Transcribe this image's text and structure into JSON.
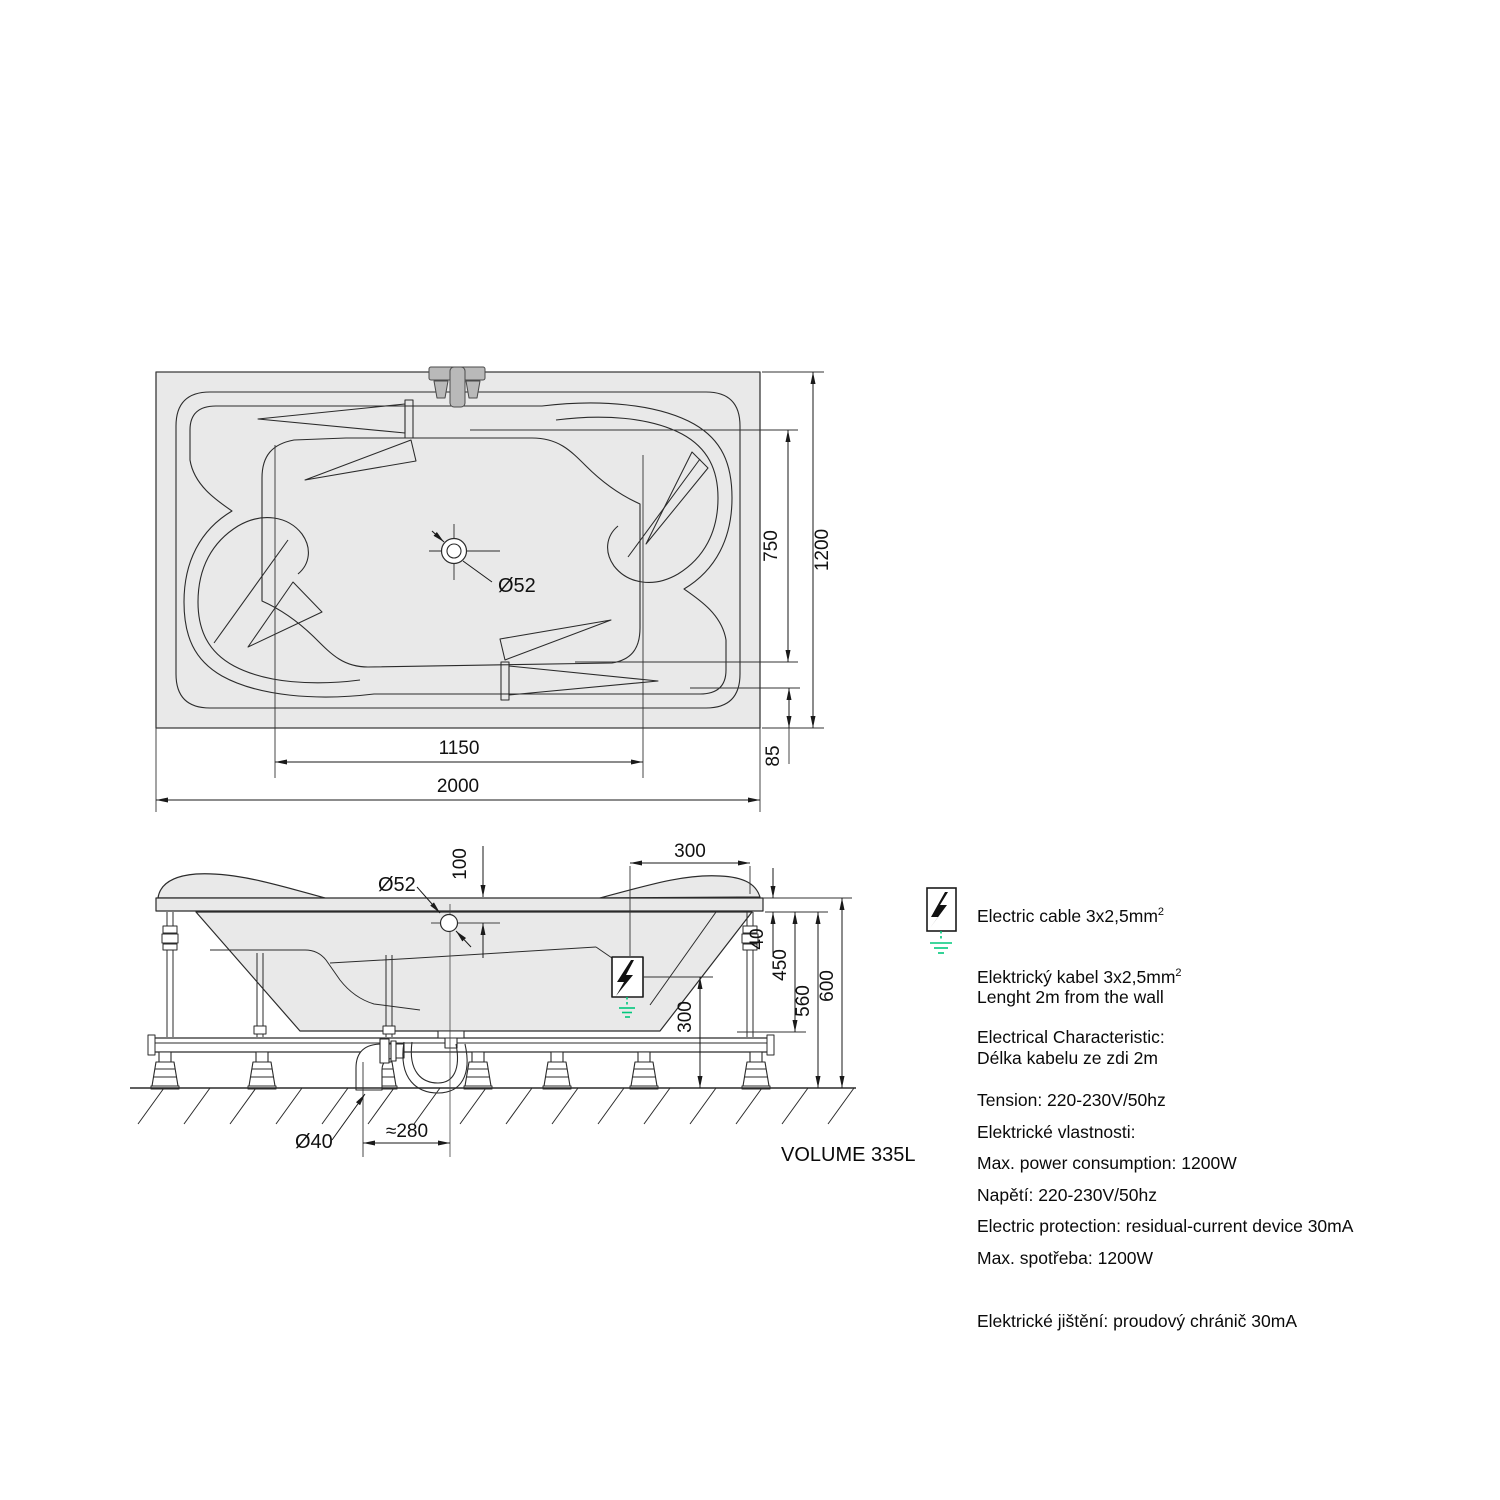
{
  "drawing": {
    "top_view": {
      "dim_width": "2000",
      "dim_inner_width": "1150",
      "dim_height": "1200",
      "dim_inner_height": "750",
      "dim_edge_offset": "85",
      "drain_diameter": "Ø52"
    },
    "side_view": {
      "drain_diameter": "Ø52",
      "dim_rim_to_drain": "100",
      "dim_cable_inset": "300",
      "dim_rim_thickness": "40",
      "dim_depth": "450",
      "dim_under_rim_height": "560",
      "dim_total_height": "600",
      "dim_connection_height": "300",
      "dim_waste_diameter": "Ø40",
      "dim_trap_offset": "≈280"
    },
    "volume_label": "VOLUME 335L"
  },
  "notes": {
    "cable_en": [
      "Electric cable 3x2,5mm",
      "Lenght 2m from the wall"
    ],
    "cable_cz": [
      "Elektrický kabel 3x2,5mm",
      "Délka kabelu ze zdi 2m"
    ],
    "sup": "2",
    "electrical_en": [
      "Electrical Characteristic:",
      "Tension: 220-230V/50hz",
      "Max. power consumption: 1200W",
      "Electric protection: residual-current device 30mA"
    ],
    "electrical_cz": [
      "Elektrické vlastnosti:",
      "Napětí: 220-230V/50hz",
      "Max. spotřeba: 1200W",
      "Elektrické jištění: proudový chránič 30mA"
    ]
  },
  "colors": {
    "ground_green": "#00c87d",
    "fill_gray": "#e9e9e9",
    "line": "#2b2b2b"
  }
}
